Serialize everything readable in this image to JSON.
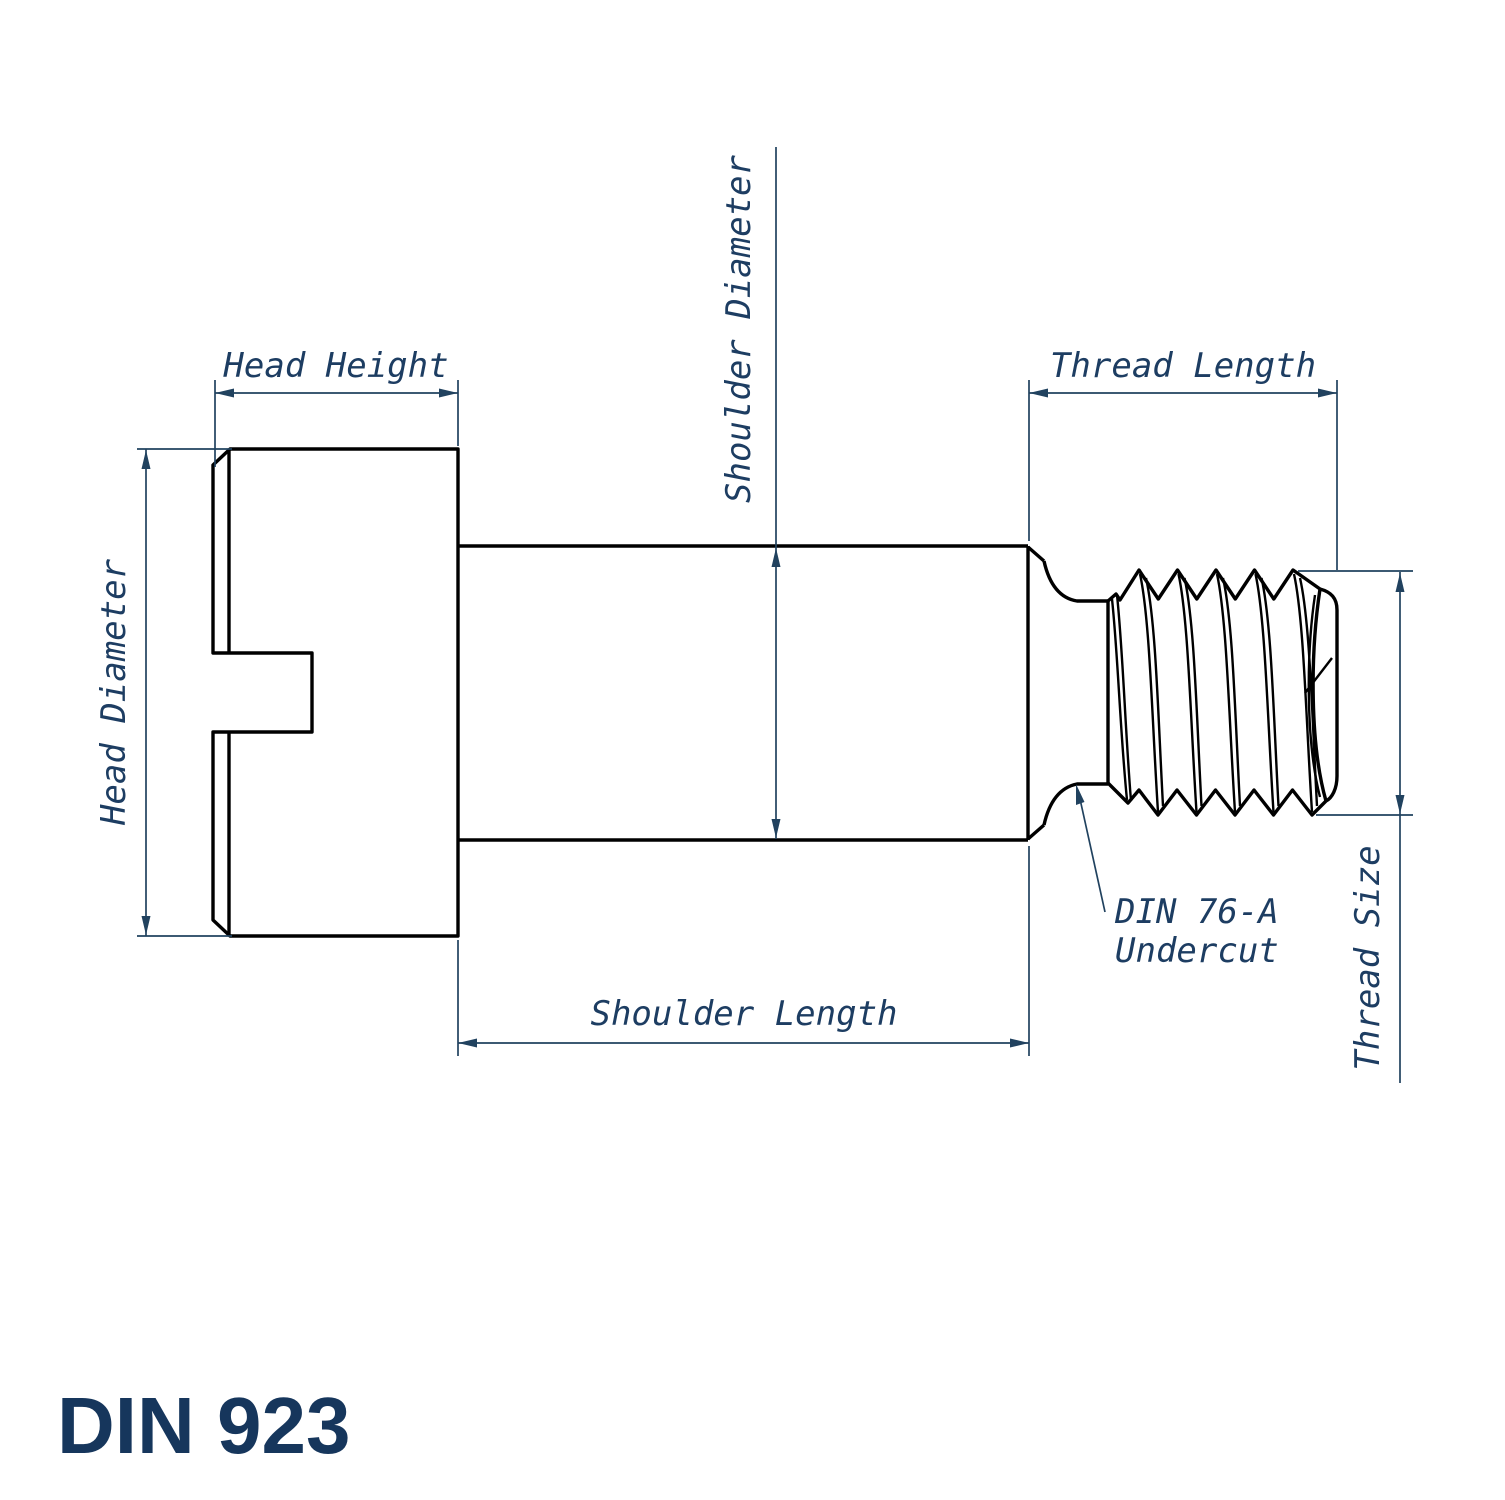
{
  "drawing": {
    "title": "DIN 923",
    "dimension_labels": {
      "head_height": "Head Height",
      "head_diameter": "Head Diameter",
      "shoulder_diameter": "Shoulder Diameter",
      "shoulder_length": "Shoulder Length",
      "thread_length": "Thread Length",
      "thread_size": "Thread Size"
    },
    "annotations": {
      "undercut_line1": "DIN 76-A",
      "undercut_line2": "Undercut"
    }
  },
  "colors": {
    "background": "#ffffff",
    "outline": "#000000",
    "dimension": "#21425f",
    "label": "#1d3d62",
    "title": "#16365c"
  }
}
